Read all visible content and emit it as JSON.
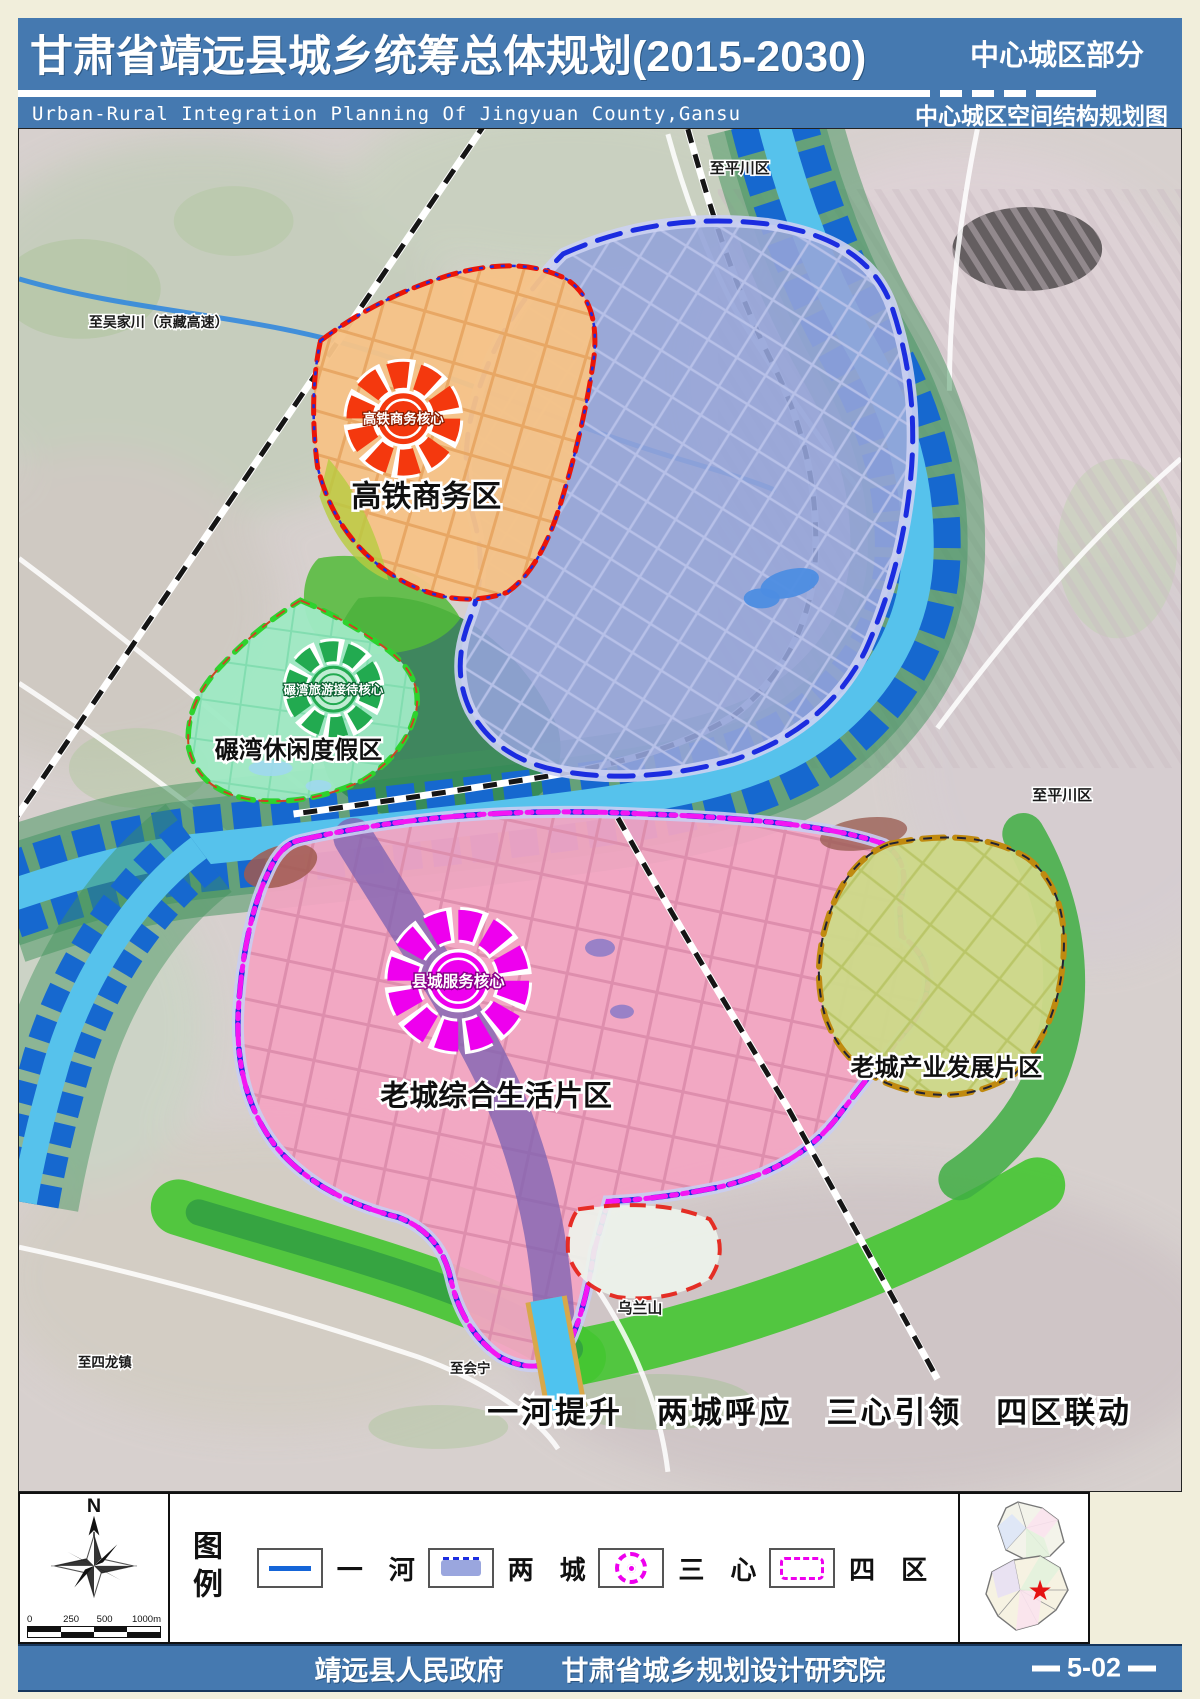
{
  "colors": {
    "header_bg": "#4579b0",
    "page_bg": "#f1eedb",
    "river_cyan": "#56c2ec",
    "river_field_blue": "#1668cf",
    "zone_hsr_fill": "#f6c387",
    "zone_hsr_core_color": "#f4380e",
    "zone_newtown_fill": "#94a3d8",
    "zone_nianwan_fill": "#9fe9c4",
    "zone_nianwan_core_color": "#22aa50",
    "zone_oldtown_fill": "#f3a5c2",
    "zone_oldtown_core_color": "#ee00ee",
    "zone_industry_fill": "#cdd989"
  },
  "header": {
    "title": "甘肃省靖远县城乡统筹总体规划(2015-2030)",
    "region_tag": "中心城区部分",
    "subtitle_en": "Urban-Rural Integration Planning Of Jingyuan County,Gansu",
    "map_name": "中心城区空间结构规划图"
  },
  "map": {
    "zones": {
      "hsr": {
        "label": "高铁商务区",
        "core": "高铁商务核心"
      },
      "nianwan": {
        "label": "碾湾休闲度假区",
        "core": "碾湾旅游接待核心"
      },
      "oldtown": {
        "label": "老城综合生活片区",
        "core": "县城服务核心"
      },
      "industry": {
        "label": "老城产业发展片区"
      }
    },
    "labels": {
      "to_pingchuan_top": "至平川区",
      "to_wujiachuan": "至吴家川（京藏高速）",
      "to_pingchuan_right": "至平川区",
      "wulanshan": "乌兰山",
      "to_silong": "至四龙镇",
      "to_huining": "至会宁"
    },
    "slogan": "一河提升　两城呼应　三心引领　四区联动"
  },
  "legend": {
    "title": "图例",
    "compass_n": "N",
    "scale_ticks": [
      "0",
      "250",
      "500",
      "1000m"
    ],
    "items": [
      {
        "label": "一　河"
      },
      {
        "label": "两　城"
      },
      {
        "label": "三　心"
      },
      {
        "label": "四　区"
      }
    ]
  },
  "inset": {
    "star": "★"
  },
  "footer": {
    "government": "靖远县人民政府",
    "institute": "甘肃省城乡规划设计研究院",
    "sheet_no": "5-02"
  }
}
